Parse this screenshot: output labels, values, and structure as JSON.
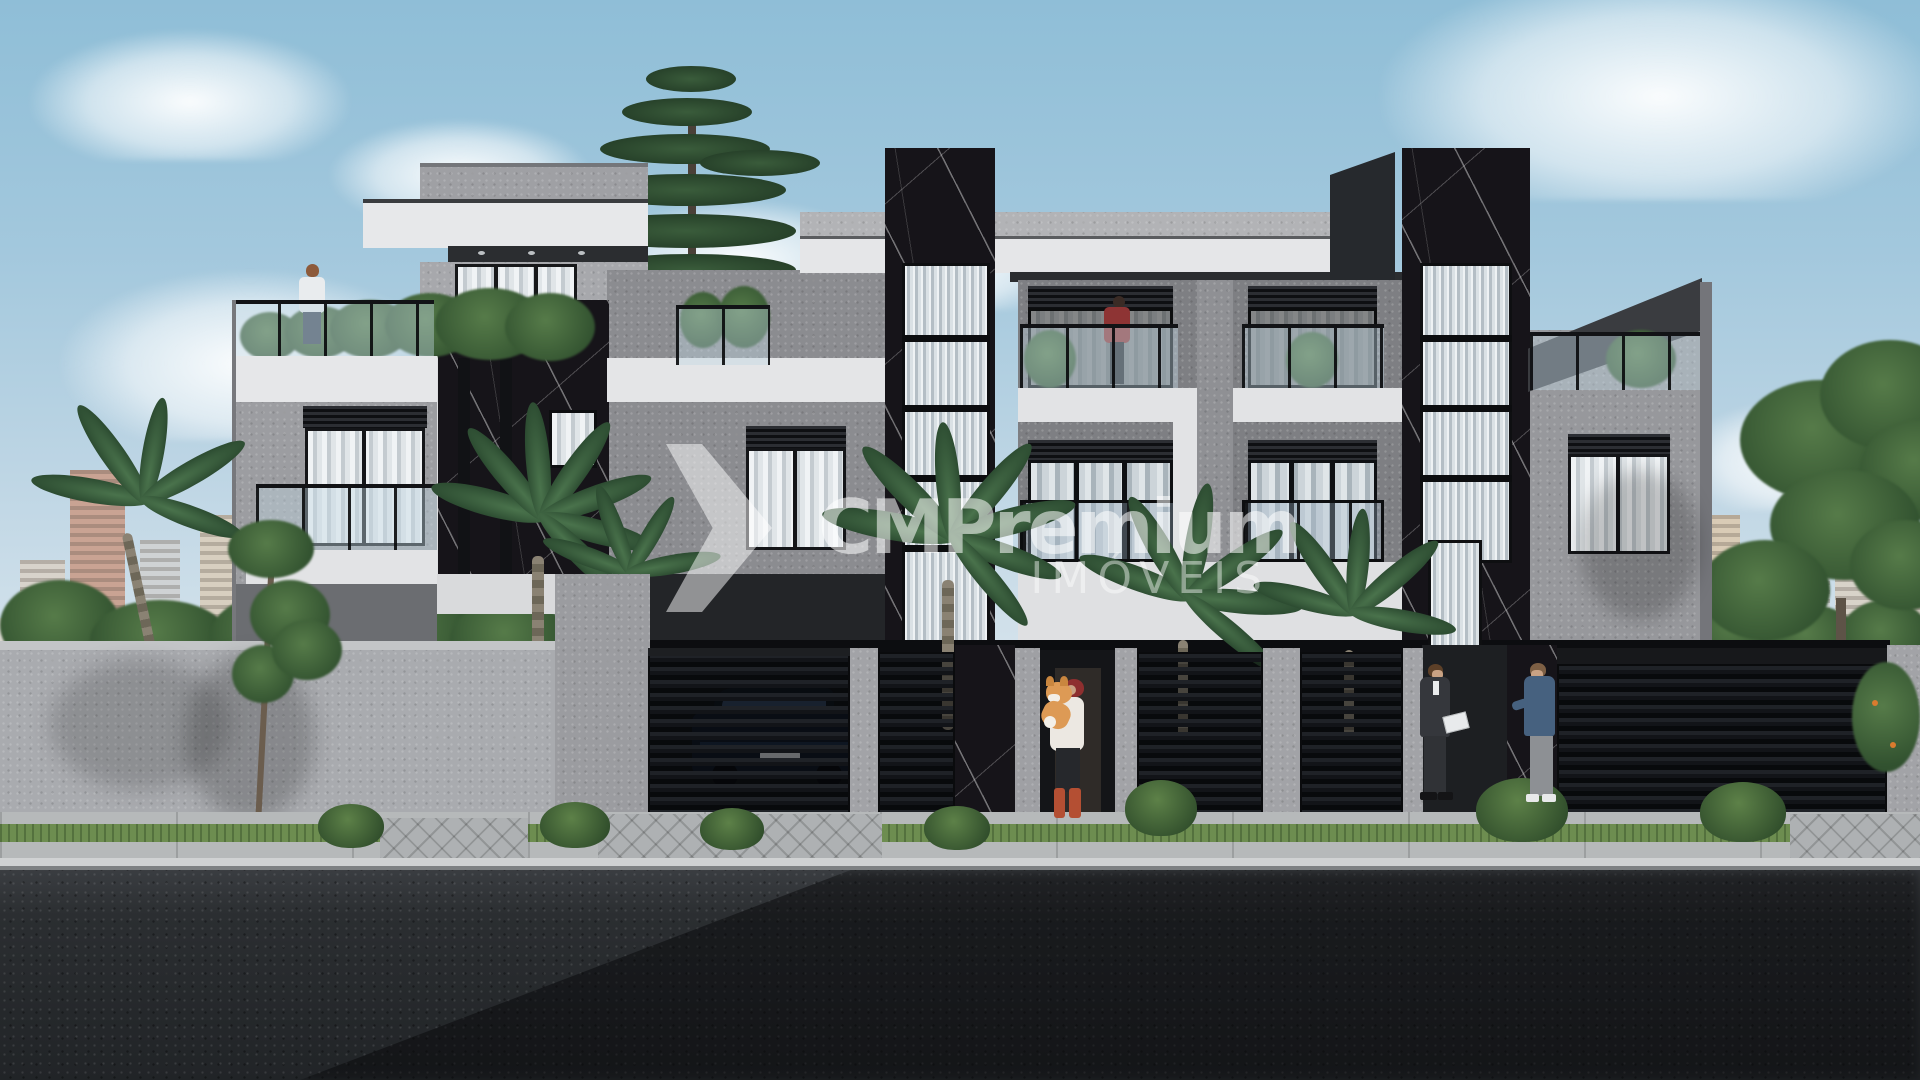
{
  "watermark": {
    "brand": "CMPremium",
    "tagline": "IMÓVEIS"
  },
  "palette": {
    "sky_top": "#8fbed7",
    "sky_horizon": "#e2eaf0",
    "cloud": "#f4f7f9",
    "stucco_light": "#e6e7e9",
    "stucco_gray": "#a9abaf",
    "facade_gray": "#7e7f83",
    "marble_black": "#161419",
    "marble_vein": "#ffffff",
    "fluted_glass": "#dae1e5",
    "window_frame": "#141518",
    "curtain": "#e0e5e8",
    "railing_glass": "#c1d6e3",
    "gate_black": "#121418",
    "palm_green": "#47704a",
    "bush_green": "#3f6138",
    "grass": "#6d8d50",
    "sidewalk": "#b6b9ba",
    "asphalt": "#24272a",
    "suv_navy": "#0d1420",
    "dog_tan": "#dd9a55",
    "woman_boots": "#b44f33",
    "suit_charcoal": "#35373c",
    "sweater_blue": "#46617f"
  }
}
